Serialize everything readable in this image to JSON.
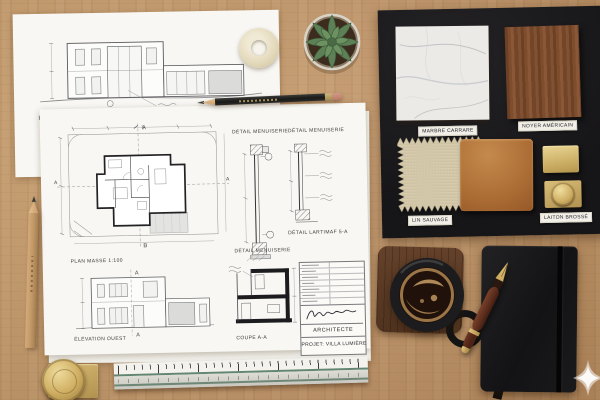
{
  "scene": {
    "description": "Architect flat-lay: blueprints, material sample board, coffee and notebook on oak desk",
    "colors": {
      "desk": "#c2966a",
      "paper": "#f8f7f3",
      "board": "#1a191b",
      "marble": "#eceae7",
      "walnut": "#7a4a2b",
      "linen": "#d9cfb4",
      "leather": "#b5773f",
      "brass": "#d3b775",
      "notebook": "#161617",
      "coffee_crema": "#c49a63"
    }
  },
  "elevation_sheet": {
    "title": "ÉLÉVATION OUEST"
  },
  "plan_sheet": {
    "plan_masse": "PLAN MASSE 1:100",
    "detail_menuiserie": "DÉTAIL MENUISERIE",
    "detail_lartimaf": "DÉTAIL LARTIMAF 5-A",
    "elevation_ouest": "ÉLÉVATION OUEST",
    "coupe": "COUPE A-A",
    "marker_a": "A",
    "marker_b": "B",
    "architecte": "ARCHITECTE",
    "projet": "PROJET: VILLA LUMIÈRE"
  },
  "board": {
    "marbre": "MARBRE CARRARE",
    "noyer": "NOYER AMÉRICAIN",
    "lin": "LIN SAUVAGE",
    "laiton": "LAITON BROSSÉ"
  },
  "icons": {
    "watermark": "sparkle-icon"
  }
}
